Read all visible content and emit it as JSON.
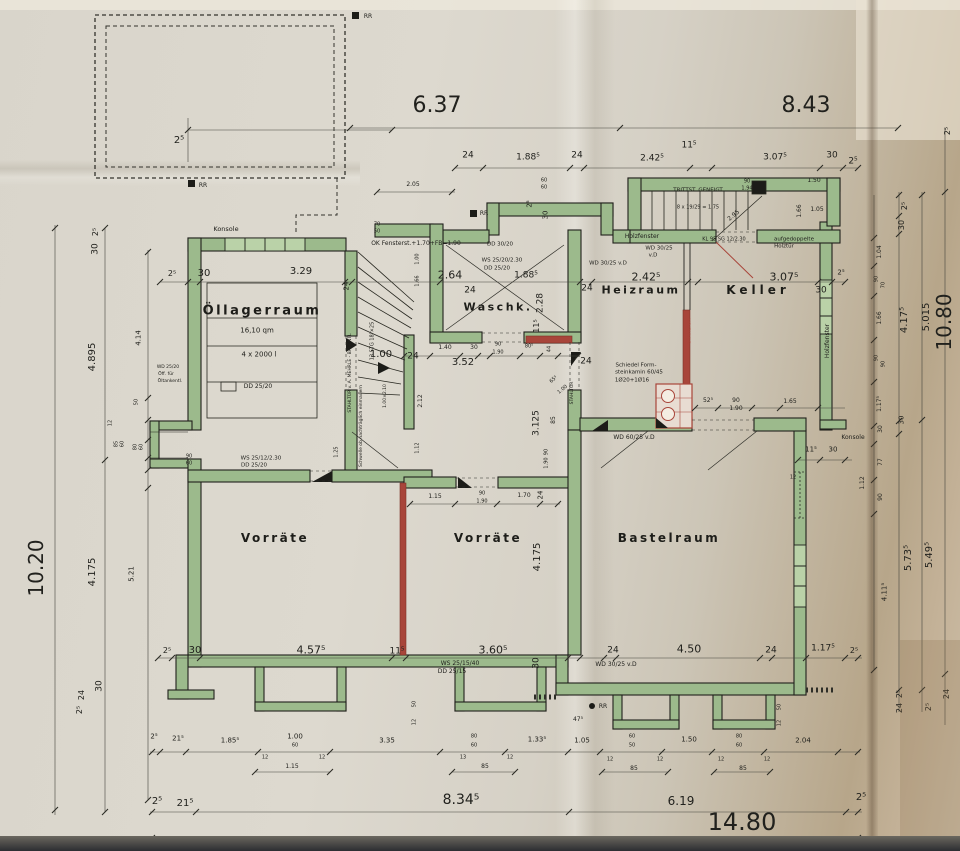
{
  "colors": {
    "paper": "#d9d5cb",
    "wall_green": "#9cba8c",
    "window_green": "#bad2a8",
    "accent_red": "#a8453a",
    "ink": "#21211d",
    "fold_tan": "#b7a68a"
  },
  "rooms": [
    {
      "name": "Öllagerraum"
    },
    {
      "name": "Waschk."
    },
    {
      "name": "Heizraum"
    },
    {
      "name": "Keller"
    },
    {
      "name": "Vorräte"
    },
    {
      "name": "Vorräte"
    },
    {
      "name": "Bastelraum"
    }
  ],
  "labels": [
    {
      "t": "6.37",
      "x": 437,
      "y": 106,
      "s": 22
    },
    {
      "t": "8.43",
      "x": 806,
      "y": 106,
      "s": 22
    },
    {
      "t": "2⁵",
      "x": 179,
      "y": 141,
      "s": 10
    },
    {
      "t": "24",
      "x": 468,
      "y": 156,
      "s": 9
    },
    {
      "t": "1.88⁵",
      "x": 528,
      "y": 158,
      "s": 9
    },
    {
      "t": "24",
      "x": 577,
      "y": 156,
      "s": 9
    },
    {
      "t": "2.42⁵",
      "x": 652,
      "y": 159,
      "s": 9
    },
    {
      "t": "11⁵",
      "x": 689,
      "y": 146,
      "s": 9
    },
    {
      "t": "3.07⁵",
      "x": 775,
      "y": 158,
      "s": 9
    },
    {
      "t": "30",
      "x": 832,
      "y": 156,
      "s": 9
    },
    {
      "t": "2⁵",
      "x": 853,
      "y": 162,
      "s": 9
    },
    {
      "t": "2.05",
      "x": 413,
      "y": 185,
      "s": 6
    },
    {
      "t": "60",
      "x": 544,
      "y": 181,
      "s": 5
    },
    {
      "t": "60",
      "x": 544,
      "y": 188,
      "s": 5
    },
    {
      "t": "RR",
      "x": 368,
      "y": 17,
      "s": 6
    },
    {
      "t": "RR",
      "x": 203,
      "y": 186,
      "s": 6
    },
    {
      "t": "RR",
      "x": 484,
      "y": 214,
      "s": 6
    },
    {
      "t": "RR",
      "x": 603,
      "y": 707,
      "s": 6
    },
    {
      "t": "Konsole",
      "x": 226,
      "y": 229,
      "s": 6.5
    },
    {
      "t": "70",
      "x": 377,
      "y": 225,
      "s": 5
    },
    {
      "t": "50",
      "x": 377,
      "y": 232,
      "s": 5
    },
    {
      "t": "OK Fensterst.+1.70+FB=1.90",
      "x": 416,
      "y": 244,
      "s": 6
    },
    {
      "t": "2⁵",
      "x": 172,
      "y": 274,
      "s": 8
    },
    {
      "t": "30",
      "x": 204,
      "y": 274,
      "s": 10
    },
    {
      "t": "3.29",
      "x": 301,
      "y": 272,
      "s": 10
    },
    {
      "t": "16,10 qm",
      "x": 257,
      "y": 331,
      "s": 7
    },
    {
      "t": "4 x 2000 l",
      "x": 259,
      "y": 355,
      "s": 7
    },
    {
      "t": "DD 25/20",
      "x": 258,
      "y": 387,
      "s": 6
    },
    {
      "t": "24",
      "x": 347,
      "y": 286,
      "r": -90,
      "s": 7
    },
    {
      "t": "2.64",
      "x": 450,
      "y": 275,
      "s": 11
    },
    {
      "t": "24",
      "x": 470,
      "y": 291,
      "s": 9
    },
    {
      "t": "1.88⁵",
      "x": 526,
      "y": 276,
      "s": 9
    },
    {
      "t": "2.28",
      "x": 541,
      "y": 303,
      "r": -90,
      "s": 9
    },
    {
      "t": "11⁵",
      "x": 537,
      "y": 326,
      "r": -90,
      "s": 8
    },
    {
      "t": "DD 30/20",
      "x": 500,
      "y": 245,
      "s": 5.5
    },
    {
      "t": "WS 25/20/2.30",
      "x": 502,
      "y": 261,
      "s": 5.5
    },
    {
      "t": "DD 25/20",
      "x": 497,
      "y": 269,
      "s": 5.5
    },
    {
      "t": "2⁵",
      "x": 530,
      "y": 204,
      "r": -90,
      "s": 7
    },
    {
      "t": "30",
      "x": 546,
      "y": 215,
      "r": -90,
      "s": 7
    },
    {
      "t": "Holzfenster",
      "x": 642,
      "y": 237,
      "s": 6
    },
    {
      "t": "WD 30/25",
      "x": 659,
      "y": 249,
      "s": 5.5
    },
    {
      "t": "v.D",
      "x": 653,
      "y": 256,
      "s": 5.5
    },
    {
      "t": "KL 95 SG 12/2.30",
      "x": 724,
      "y": 240,
      "s": 5
    },
    {
      "t": "aufgedoppelte",
      "x": 794,
      "y": 240,
      "s": 5.5
    },
    {
      "t": "Holztür",
      "x": 784,
      "y": 247,
      "s": 5.5
    },
    {
      "t": "TRITTST. GENEIGT",
      "x": 698,
      "y": 191,
      "s": 5.5
    },
    {
      "t": "8 x 19/29 = 1.75",
      "x": 698,
      "y": 208,
      "s": 5
    },
    {
      "t": "90",
      "x": 747,
      "y": 182,
      "s": 5
    },
    {
      "t": "1.94",
      "x": 747,
      "y": 189,
      "s": 5
    },
    {
      "t": "2.95",
      "x": 734,
      "y": 216,
      "r": -40,
      "s": 6
    },
    {
      "t": "1.50",
      "x": 814,
      "y": 181,
      "s": 6
    },
    {
      "t": "1.66",
      "x": 800,
      "y": 211,
      "r": -90,
      "s": 6
    },
    {
      "t": "1.05",
      "x": 817,
      "y": 210,
      "s": 6
    },
    {
      "t": "WD 30/25 v.D",
      "x": 608,
      "y": 264,
      "s": 5.5
    },
    {
      "t": "2.42⁵",
      "x": 646,
      "y": 277,
      "s": 11
    },
    {
      "t": "3.07⁵",
      "x": 784,
      "y": 277,
      "s": 11
    },
    {
      "t": "30",
      "x": 821,
      "y": 291,
      "s": 9
    },
    {
      "t": "24",
      "x": 587,
      "y": 289,
      "s": 9
    },
    {
      "t": "24",
      "x": 586,
      "y": 362,
      "s": 9
    },
    {
      "t": "2⁵",
      "x": 841,
      "y": 273,
      "s": 7
    },
    {
      "t": "STAHLTÜR",
      "x": 690,
      "y": 331,
      "r": -90,
      "s": 5,
      "c": "red"
    },
    {
      "t": "Schiedel Form-",
      "x": 636,
      "y": 366,
      "s": 5.5
    },
    {
      "t": "steinkamin 60/45",
      "x": 639,
      "y": 373,
      "s": 5.5
    },
    {
      "t": "1Ø20+1Ø16",
      "x": 632,
      "y": 381,
      "s": 5.5
    },
    {
      "t": "52⁵",
      "x": 708,
      "y": 401,
      "s": 6
    },
    {
      "t": "90",
      "x": 736,
      "y": 401,
      "s": 6
    },
    {
      "t": "1.90",
      "x": 736,
      "y": 409,
      "s": 6
    },
    {
      "t": "1.65",
      "x": 790,
      "y": 402,
      "s": 6
    },
    {
      "t": "Holzfenster",
      "x": 828,
      "y": 341,
      "r": -90,
      "s": 6
    },
    {
      "t": "Konsole",
      "x": 853,
      "y": 438,
      "s": 6
    },
    {
      "t": "24",
      "x": 413,
      "y": 357,
      "s": 9
    },
    {
      "t": "1.40",
      "x": 445,
      "y": 348,
      "s": 6
    },
    {
      "t": "30",
      "x": 474,
      "y": 348,
      "s": 6
    },
    {
      "t": "90",
      "x": 498,
      "y": 345,
      "s": 5
    },
    {
      "t": "1.90",
      "x": 498,
      "y": 353,
      "s": 5
    },
    {
      "t": "80⁵",
      "x": 529,
      "y": 347,
      "s": 5
    },
    {
      "t": "44",
      "x": 550,
      "y": 349,
      "r": -90,
      "s": 5
    },
    {
      "t": "3.52",
      "x": 463,
      "y": 363,
      "s": 10
    },
    {
      "t": "1.00",
      "x": 381,
      "y": 355,
      "s": 10
    },
    {
      "t": "STAHLTÜR",
      "x": 573,
      "y": 393,
      "r": -90,
      "s": 4.5
    },
    {
      "t": "65⁵",
      "x": 554,
      "y": 380,
      "r": -40,
      "s": 5
    },
    {
      "t": "1.00",
      "x": 563,
      "y": 390,
      "r": -40,
      "s": 5
    },
    {
      "t": "3.125",
      "x": 537,
      "y": 423,
      "r": -90,
      "s": 9
    },
    {
      "t": "85",
      "x": 554,
      "y": 420,
      "r": -90,
      "s": 6
    },
    {
      "t": "90",
      "x": 547,
      "y": 452,
      "r": -90,
      "s": 5
    },
    {
      "t": "1.90",
      "x": 547,
      "y": 463,
      "r": -90,
      "s": 5
    },
    {
      "t": "WD 60/25 v.D",
      "x": 634,
      "y": 438,
      "s": 6
    },
    {
      "t": "13 STG 18⁵×25",
      "x": 373,
      "y": 341,
      "r": -90,
      "s": 5
    },
    {
      "t": "1.00×2.10",
      "x": 386,
      "y": 396,
      "r": -90,
      "s": 4.5
    },
    {
      "t": "STAHLTÜR v. A. MEHRLE - BAUENTL",
      "x": 351,
      "y": 373,
      "r": -90,
      "s": 4.5
    },
    {
      "t": "Schwelle ob nachträglich einmauern",
      "x": 362,
      "y": 426,
      "r": -90,
      "s": 4.5
    },
    {
      "t": "1.00",
      "x": 418,
      "y": 259,
      "r": -90,
      "s": 5
    },
    {
      "t": "1.66",
      "x": 418,
      "y": 281,
      "r": -90,
      "s": 5
    },
    {
      "t": "2.12",
      "x": 421,
      "y": 401,
      "r": -90,
      "s": 6
    },
    {
      "t": "1.12",
      "x": 418,
      "y": 448,
      "r": -90,
      "s": 5
    },
    {
      "t": "90",
      "x": 189,
      "y": 457,
      "s": 5
    },
    {
      "t": "60",
      "x": 189,
      "y": 464,
      "s": 5
    },
    {
      "t": "WS 25/12/2.30",
      "x": 261,
      "y": 459,
      "s": 5.5
    },
    {
      "t": "DD 25/20",
      "x": 254,
      "y": 466,
      "s": 5.5
    },
    {
      "t": "1.25",
      "x": 337,
      "y": 452,
      "r": -90,
      "s": 5
    },
    {
      "t": "2⁵",
      "x": 167,
      "y": 651,
      "s": 8
    },
    {
      "t": "30",
      "x": 195,
      "y": 651,
      "s": 10
    },
    {
      "t": "4.57⁵",
      "x": 311,
      "y": 650,
      "s": 11
    },
    {
      "t": "11⁵",
      "x": 397,
      "y": 652,
      "s": 9
    },
    {
      "t": "2⁵",
      "x": 80,
      "y": 710,
      "r": -90,
      "s": 8
    },
    {
      "t": "24",
      "x": 82,
      "y": 695,
      "r": -90,
      "s": 8
    },
    {
      "t": "30",
      "x": 100,
      "y": 686,
      "r": -90,
      "s": 9
    },
    {
      "t": "10.20",
      "x": 36,
      "y": 568,
      "r": -90,
      "s": 20
    },
    {
      "t": "4.175",
      "x": 93,
      "y": 572,
      "r": -90,
      "s": 10
    },
    {
      "t": "5.21",
      "x": 132,
      "y": 574,
      "r": -90,
      "s": 7
    },
    {
      "t": "4.895",
      "x": 93,
      "y": 357,
      "r": -90,
      "s": 10
    },
    {
      "t": "4.14",
      "x": 139,
      "y": 338,
      "r": -90,
      "s": 7
    },
    {
      "t": "30",
      "x": 96,
      "y": 249,
      "r": -90,
      "s": 9
    },
    {
      "t": "2⁵",
      "x": 96,
      "y": 232,
      "r": -90,
      "s": 8
    },
    {
      "t": "12",
      "x": 111,
      "y": 423,
      "r": -90,
      "s": 5
    },
    {
      "t": "85",
      "x": 117,
      "y": 444,
      "r": -90,
      "s": 5
    },
    {
      "t": "60",
      "x": 123,
      "y": 444,
      "r": -90,
      "s": 5
    },
    {
      "t": "80",
      "x": 136,
      "y": 447,
      "r": -90,
      "s": 5
    },
    {
      "t": "60",
      "x": 142,
      "y": 447,
      "r": -90,
      "s": 5
    },
    {
      "t": "50",
      "x": 137,
      "y": 402,
      "r": -90,
      "s": 5
    },
    {
      "t": "WD 25/20",
      "x": 168,
      "y": 368,
      "s": 4.5
    },
    {
      "t": "Öff. für",
      "x": 166,
      "y": 375,
      "s": 4.5
    },
    {
      "t": "Öltankentl.",
      "x": 170,
      "y": 382,
      "s": 4.5
    },
    {
      "t": "1.15",
      "x": 435,
      "y": 497,
      "s": 6
    },
    {
      "t": "90",
      "x": 482,
      "y": 494,
      "s": 5
    },
    {
      "t": "1.90",
      "x": 482,
      "y": 502,
      "s": 5
    },
    {
      "t": "1.70",
      "x": 524,
      "y": 496,
      "s": 6
    },
    {
      "t": "24",
      "x": 541,
      "y": 495,
      "r": -90,
      "s": 7
    },
    {
      "t": "4.175",
      "x": 538,
      "y": 557,
      "r": -90,
      "s": 10
    },
    {
      "t": "3.60⁵",
      "x": 493,
      "y": 650,
      "s": 11
    },
    {
      "t": "30",
      "x": 537,
      "y": 663,
      "r": -90,
      "s": 9
    },
    {
      "t": "WS 25/15/40",
      "x": 460,
      "y": 664,
      "s": 6
    },
    {
      "t": "DD 25/15",
      "x": 452,
      "y": 672,
      "s": 6
    },
    {
      "t": "24",
      "x": 613,
      "y": 651,
      "s": 9
    },
    {
      "t": "4.50",
      "x": 689,
      "y": 649,
      "s": 11
    },
    {
      "t": "24",
      "x": 771,
      "y": 651,
      "s": 9
    },
    {
      "t": "1.17⁵",
      "x": 823,
      "y": 649,
      "s": 9
    },
    {
      "t": "2⁵",
      "x": 854,
      "y": 651,
      "s": 8
    },
    {
      "t": "WD 30/25 v.D",
      "x": 616,
      "y": 665,
      "s": 6
    },
    {
      "t": "11⁵",
      "x": 811,
      "y": 450,
      "s": 7
    },
    {
      "t": "30",
      "x": 833,
      "y": 450,
      "s": 7
    },
    {
      "t": "12",
      "x": 793,
      "y": 478,
      "s": 5
    },
    {
      "t": "1.12",
      "x": 863,
      "y": 483,
      "r": -90,
      "s": 6
    },
    {
      "t": "2⁵",
      "x": 154,
      "y": 737,
      "s": 7
    },
    {
      "t": "21⁵",
      "x": 178,
      "y": 739,
      "s": 7
    },
    {
      "t": "1.85⁵",
      "x": 230,
      "y": 741,
      "s": 7
    },
    {
      "t": "1.00",
      "x": 295,
      "y": 737,
      "s": 7
    },
    {
      "t": "60",
      "x": 295,
      "y": 746,
      "s": 5
    },
    {
      "t": "12",
      "x": 265,
      "y": 758,
      "s": 5
    },
    {
      "t": "1.15",
      "x": 292,
      "y": 767,
      "s": 6
    },
    {
      "t": "12",
      "x": 322,
      "y": 758,
      "s": 5
    },
    {
      "t": "3.35",
      "x": 387,
      "y": 741,
      "s": 7
    },
    {
      "t": "50",
      "x": 415,
      "y": 704,
      "r": -90,
      "s": 5
    },
    {
      "t": "12",
      "x": 415,
      "y": 722,
      "r": -90,
      "s": 5
    },
    {
      "t": "80",
      "x": 474,
      "y": 737,
      "s": 5
    },
    {
      "t": "60",
      "x": 474,
      "y": 746,
      "s": 5
    },
    {
      "t": "13",
      "x": 463,
      "y": 758,
      "s": 5
    },
    {
      "t": "85",
      "x": 485,
      "y": 767,
      "s": 6
    },
    {
      "t": "12",
      "x": 510,
      "y": 758,
      "s": 5
    },
    {
      "t": "1.33⁵",
      "x": 537,
      "y": 740,
      "s": 7
    },
    {
      "t": "1.05",
      "x": 582,
      "y": 741,
      "s": 7
    },
    {
      "t": "47⁵",
      "x": 578,
      "y": 720,
      "s": 6
    },
    {
      "t": "60",
      "x": 632,
      "y": 737,
      "s": 5
    },
    {
      "t": "50",
      "x": 632,
      "y": 746,
      "s": 5
    },
    {
      "t": "12",
      "x": 610,
      "y": 760,
      "s": 5
    },
    {
      "t": "85",
      "x": 634,
      "y": 769,
      "s": 6
    },
    {
      "t": "12",
      "x": 660,
      "y": 760,
      "s": 5
    },
    {
      "t": "1.50",
      "x": 689,
      "y": 740,
      "s": 7
    },
    {
      "t": "80",
      "x": 739,
      "y": 737,
      "s": 5
    },
    {
      "t": "60",
      "x": 739,
      "y": 746,
      "s": 5
    },
    {
      "t": "12",
      "x": 721,
      "y": 760,
      "s": 5
    },
    {
      "t": "85",
      "x": 743,
      "y": 769,
      "s": 6
    },
    {
      "t": "12",
      "x": 767,
      "y": 760,
      "s": 5
    },
    {
      "t": "50",
      "x": 780,
      "y": 707,
      "r": -90,
      "s": 5
    },
    {
      "t": "12",
      "x": 780,
      "y": 723,
      "r": -90,
      "s": 5
    },
    {
      "t": "2.04",
      "x": 803,
      "y": 741,
      "s": 7
    },
    {
      "t": "2⁵",
      "x": 157,
      "y": 802,
      "s": 10
    },
    {
      "t": "21⁵",
      "x": 185,
      "y": 804,
      "s": 10
    },
    {
      "t": "8.34⁵",
      "x": 461,
      "y": 800,
      "s": 14
    },
    {
      "t": "6.19",
      "x": 681,
      "y": 801,
      "s": 12
    },
    {
      "t": "2⁵",
      "x": 861,
      "y": 798,
      "s": 10
    },
    {
      "t": "14.80",
      "x": 742,
      "y": 822,
      "s": 24
    },
    {
      "t": "2⁵",
      "x": 900,
      "y": 694,
      "r": -90,
      "s": 8
    },
    {
      "t": "24",
      "x": 900,
      "y": 708,
      "r": -90,
      "s": 8
    },
    {
      "t": "2⁵",
      "x": 929,
      "y": 707,
      "r": -90,
      "s": 8
    },
    {
      "t": "24",
      "x": 947,
      "y": 694,
      "r": -90,
      "s": 8
    },
    {
      "t": "1.04",
      "x": 880,
      "y": 252,
      "r": -90,
      "s": 6
    },
    {
      "t": "90",
      "x": 877,
      "y": 279,
      "r": -90,
      "s": 5
    },
    {
      "t": "70",
      "x": 884,
      "y": 285,
      "r": -90,
      "s": 5
    },
    {
      "t": "1.66",
      "x": 880,
      "y": 318,
      "r": -90,
      "s": 6
    },
    {
      "t": "90",
      "x": 877,
      "y": 358,
      "r": -90,
      "s": 5
    },
    {
      "t": "90",
      "x": 884,
      "y": 364,
      "r": -90,
      "s": 5
    },
    {
      "t": "1.17⁵",
      "x": 880,
      "y": 404,
      "r": -90,
      "s": 6
    },
    {
      "t": "30",
      "x": 881,
      "y": 429,
      "r": -90,
      "s": 6
    },
    {
      "t": "77",
      "x": 881,
      "y": 462,
      "r": -90,
      "s": 6
    },
    {
      "t": "90",
      "x": 881,
      "y": 497,
      "r": -90,
      "s": 6
    },
    {
      "t": "4.11⁵",
      "x": 885,
      "y": 592,
      "r": -90,
      "s": 7
    },
    {
      "t": "2⁵",
      "x": 905,
      "y": 206,
      "r": -90,
      "s": 8
    },
    {
      "t": "30",
      "x": 902,
      "y": 225,
      "r": -90,
      "s": 8
    },
    {
      "t": "4.17⁵",
      "x": 905,
      "y": 320,
      "r": -90,
      "s": 10
    },
    {
      "t": "30",
      "x": 902,
      "y": 420,
      "r": -90,
      "s": 7
    },
    {
      "t": "5.73⁵",
      "x": 909,
      "y": 558,
      "r": -90,
      "s": 10
    },
    {
      "t": "5.015",
      "x": 927,
      "y": 317,
      "r": -90,
      "s": 10
    },
    {
      "t": "5.49⁵",
      "x": 930,
      "y": 555,
      "r": -90,
      "s": 10
    },
    {
      "t": "10.80",
      "x": 944,
      "y": 322,
      "r": -90,
      "s": 20
    },
    {
      "t": "2⁵",
      "x": 948,
      "y": 131,
      "r": -90,
      "s": 8
    }
  ]
}
